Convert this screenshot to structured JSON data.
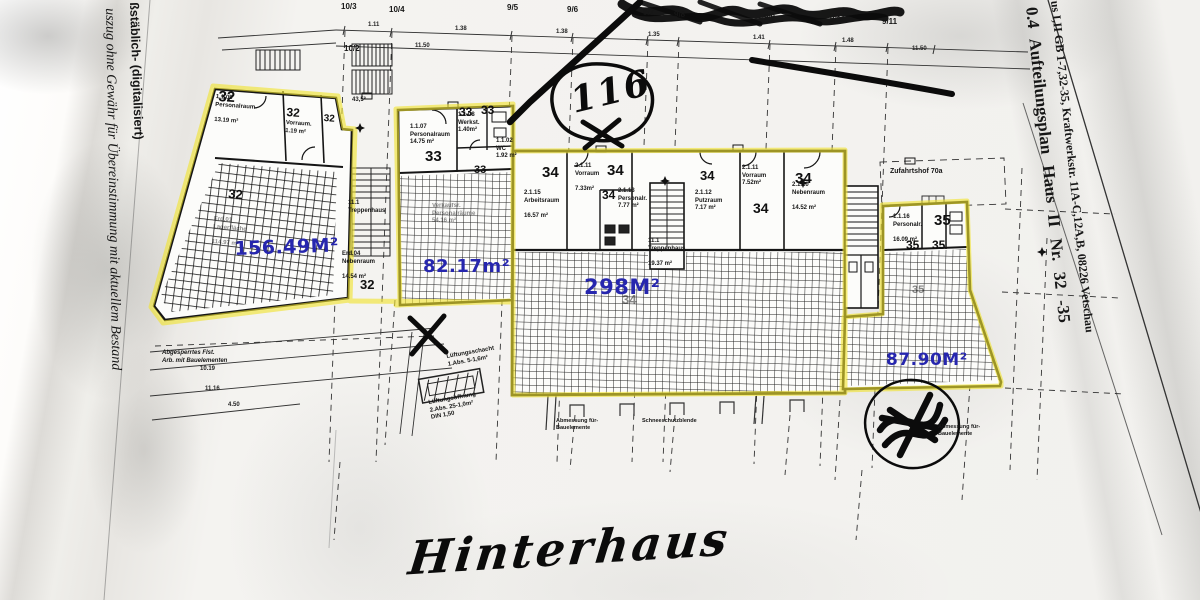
{
  "colors": {
    "highlight_yellow": "#f1e32f",
    "area_blue": "#2626ae",
    "ink": "#161616",
    "paper": "#f2f1ee"
  },
  "margin_left": {
    "line1": "ßstäblich- (digitalisiert)",
    "line2": "uszug ohne Gewähr für Übereinstimmung mit aktuellem Bestand"
  },
  "margin_right": {
    "title": "0.4   Aufteilungsplan  Haus II  Nr. 32 -35",
    "subtitle": "us I,II GB 1-7,32-35, Kraftwerkstr. 11A-C,12A,B, 08226 Vetschau"
  },
  "annotations": {
    "circled_number": "116",
    "handwritten_caption": "Hinterhaus"
  },
  "angle_note": "43,5°",
  "grid_labels": [
    "10/3",
    "10/4",
    "9/5",
    "9/6",
    "9/7",
    "9/8",
    "9/9",
    "9/10",
    "9/11",
    "10/2"
  ],
  "dimensions_top": [
    "1.11",
    "1.38",
    "11.50",
    "1.38",
    "1.35",
    "1.41",
    "11.50",
    "1.48"
  ],
  "dimensions_bottom": [
    "10.19",
    "11.16",
    "4.50"
  ],
  "units": [
    {
      "number": "32",
      "area": "156.49M²"
    },
    {
      "number": "33",
      "area": "82.17m²"
    },
    {
      "number": "34",
      "area": "298M²"
    },
    {
      "number": "35",
      "area": "87.90M²"
    }
  ],
  "rooms": [
    "1.1.05\nPersonalraum\n\n13.19 m²",
    "Vorraum.\n1.19 m²",
    "Erd.01\nLagerfläche\n\n114.97 m²",
    "11.1\nTreppenhaus",
    "Erd.04\nNebenraum\n\n14.54 m²",
    "1.1.07\nPersonalraum\n14.75 m²",
    "1.1.08\nWerkst.\n1.40m²",
    "Verkaufsr.\nPersonalräume\n54.16 m²",
    "2.1.15\nArbeitsraum\n\n16.57 m²",
    "2.1.11\nVorraum\n\n7.33m²",
    "2.1.13\nPersonalr.\n7.77 m²",
    "2.1.12\nPutzraum\n7.17 m²",
    "2.1.11\nVorraum\n7.52m²",
    "2.1.10\nNebenraum\n\n14.52 m²",
    "11.1\nTreppenhaus\n\n19.37 m²",
    "1.1.16\nPersonalr.\n\n16.09 m²",
    "1.1.02\nWC\n1.92 m²"
  ],
  "site": {
    "courtyard": "Zufahrtshof 70a",
    "barrier_note": "Abgesperrtes Flst.\nArb. mit Bauelementen",
    "vent_shaft": "Lüftungsschacht\n1.Abs. 5-1,6m²",
    "vent_opening": "Lüftungsöffnung\n2.Abs. 25-1,0m²\nDIN 1,50",
    "ground_note": "Abmessung für-\nBauelemente",
    "row_note": "Schneeschutzblende"
  }
}
